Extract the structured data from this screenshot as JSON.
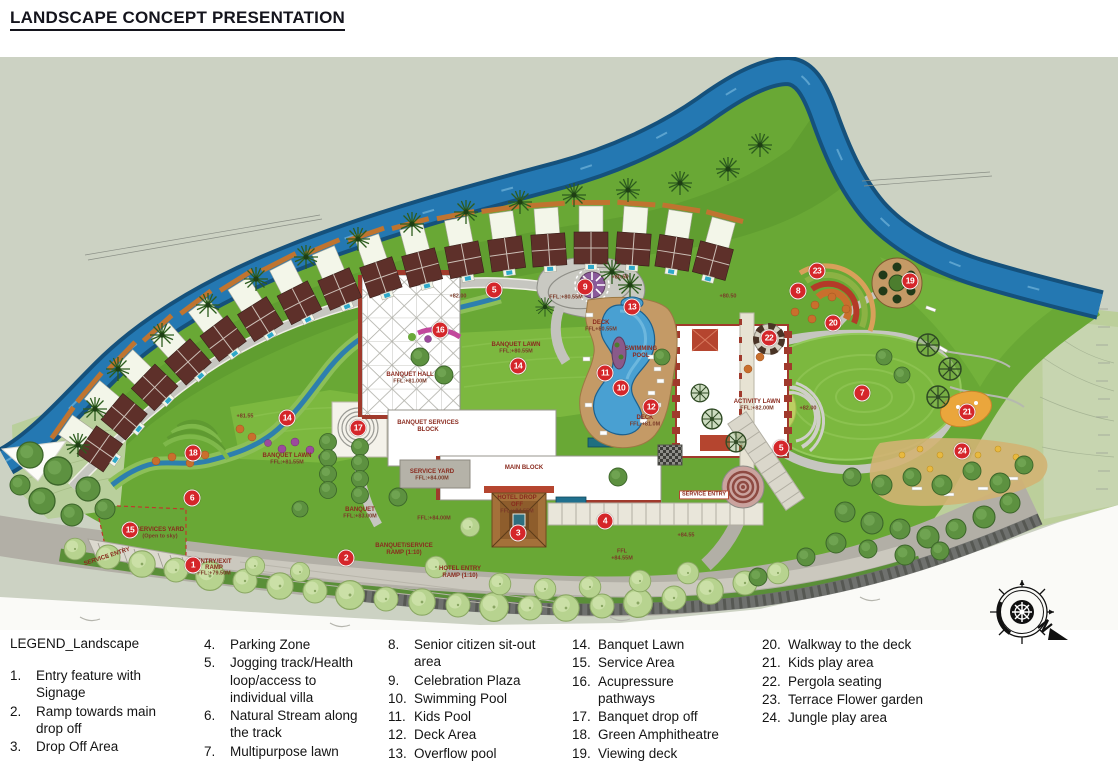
{
  "title": "LANDSCAPE CONCEPT PRESENTATION",
  "legend": {
    "title": "LEGEND_Landscape",
    "columns": [
      {
        "items": [
          {
            "n": "1.",
            "t": "Entry feature with Signage"
          },
          {
            "n": "2.",
            "t": "Ramp towards main drop off"
          },
          {
            "n": "3.",
            "t": "Drop Off Area"
          }
        ]
      },
      {
        "items": [
          {
            "n": "4.",
            "t": "Parking Zone"
          },
          {
            "n": "5.",
            "t": "Jogging track/Health loop/access to individual villa"
          },
          {
            "n": "6.",
            "t": "Natural Stream along the track"
          },
          {
            "n": "7.",
            "t": "Multipurpose lawn"
          }
        ]
      },
      {
        "items": [
          {
            "n": "8.",
            "t": "Senior citizen sit-out area"
          },
          {
            "n": "9.",
            "t": "Celebration Plaza"
          },
          {
            "n": "10.",
            "t": "Swimming Pool"
          },
          {
            "n": "11.",
            "t": "Kids Pool"
          },
          {
            "n": "12.",
            "t": "Deck Area"
          },
          {
            "n": "13.",
            "t": "Overflow pool"
          }
        ]
      },
      {
        "items": [
          {
            "n": "14.",
            "t": "Banquet Lawn"
          },
          {
            "n": "15.",
            "t": "Service Area"
          },
          {
            "n": "16.",
            "t": "Acupressure pathways"
          },
          {
            "n": "17.",
            "t": "Banquet drop off"
          },
          {
            "n": "18.",
            "t": "Green Amphitheatre"
          },
          {
            "n": "19.",
            "t": "Viewing deck"
          }
        ]
      },
      {
        "items": [
          {
            "n": "20.",
            "t": "Walkway to the deck"
          },
          {
            "n": "21.",
            "t": "Kids play area"
          },
          {
            "n": "22.",
            "t": "Pergola seating"
          },
          {
            "n": "23.",
            "t": "Terrace Flower garden"
          },
          {
            "n": "24.",
            "t": "Jungle play area"
          }
        ]
      }
    ]
  },
  "map": {
    "markers": [
      {
        "n": "1",
        "x": 193,
        "y": 508
      },
      {
        "n": "2",
        "x": 346,
        "y": 501
      },
      {
        "n": "3",
        "x": 518,
        "y": 476
      },
      {
        "n": "4",
        "x": 605,
        "y": 464
      },
      {
        "n": "5",
        "x": 494,
        "y": 233
      },
      {
        "n": "5",
        "x": 781,
        "y": 391
      },
      {
        "n": "6",
        "x": 192,
        "y": 441
      },
      {
        "n": "7",
        "x": 862,
        "y": 336
      },
      {
        "n": "8",
        "x": 798,
        "y": 234
      },
      {
        "n": "9",
        "x": 585,
        "y": 230
      },
      {
        "n": "10",
        "x": 621,
        "y": 331
      },
      {
        "n": "11",
        "x": 605,
        "y": 316
      },
      {
        "n": "12",
        "x": 651,
        "y": 350
      },
      {
        "n": "13",
        "x": 632,
        "y": 250
      },
      {
        "n": "14",
        "x": 518,
        "y": 309
      },
      {
        "n": "14",
        "x": 287,
        "y": 361
      },
      {
        "n": "15",
        "x": 130,
        "y": 473
      },
      {
        "n": "16",
        "x": 440,
        "y": 273
      },
      {
        "n": "17",
        "x": 358,
        "y": 371
      },
      {
        "n": "18",
        "x": 193,
        "y": 396
      },
      {
        "n": "19",
        "x": 910,
        "y": 224
      },
      {
        "n": "20",
        "x": 833,
        "y": 266
      },
      {
        "n": "21",
        "x": 967,
        "y": 355
      },
      {
        "n": "22",
        "x": 769,
        "y": 281
      },
      {
        "n": "23",
        "x": 817,
        "y": 214
      },
      {
        "n": "24",
        "x": 962,
        "y": 394
      }
    ],
    "labels": [
      {
        "t": "BANQUET HALL",
        "x": 410,
        "y": 318
      },
      {
        "t": "FFL:+81.00M",
        "x": 410,
        "y": 325,
        "c": "elev"
      },
      {
        "t": "BANQUET LAWN",
        "x": 516,
        "y": 288
      },
      {
        "t": "FFL:+80.55M",
        "x": 516,
        "y": 295,
        "c": "elev"
      },
      {
        "t": "BANQUET LAWN",
        "x": 287,
        "y": 399
      },
      {
        "t": "FFL:+81.55M",
        "x": 287,
        "y": 406,
        "c": "elev"
      },
      {
        "t": "BANQUET SERVICES",
        "x": 428,
        "y": 366
      },
      {
        "t": "BLOCK",
        "x": 428,
        "y": 373
      },
      {
        "t": "MAIN BLOCK",
        "x": 524,
        "y": 411
      },
      {
        "t": "SERVICE YARD",
        "x": 432,
        "y": 415
      },
      {
        "t": "FFL:+84.00M",
        "x": 432,
        "y": 422,
        "c": "elev"
      },
      {
        "t": "SERVICES YARD",
        "x": 160,
        "y": 473
      },
      {
        "t": "(Open to sky)",
        "x": 160,
        "y": 480,
        "c": "elev"
      },
      {
        "t": "SERVICE ENTRY",
        "x": 107,
        "y": 500,
        "r": -18
      },
      {
        "t": "SERVICE ENTRY",
        "x": 704,
        "y": 438,
        "c": "boxed",
        "s": 5.5
      },
      {
        "t": "HOTEL DROP",
        "x": 517,
        "y": 441
      },
      {
        "t": "OFF",
        "x": 517,
        "y": 448
      },
      {
        "t": "FFL:+84.55M",
        "x": 517,
        "y": 455,
        "c": "elev"
      },
      {
        "t": "SWIMMING",
        "x": 641,
        "y": 292
      },
      {
        "t": "POOL",
        "x": 641,
        "y": 299
      },
      {
        "t": "DECK",
        "x": 601,
        "y": 266
      },
      {
        "t": "FFL+80.55M",
        "x": 601,
        "y": 273,
        "c": "elev"
      },
      {
        "t": "DECK",
        "x": 645,
        "y": 361
      },
      {
        "t": "FFL:+81.0M",
        "x": 645,
        "y": 368,
        "c": "elev"
      },
      {
        "t": "BANQUET",
        "x": 360,
        "y": 453
      },
      {
        "t": "FFL:+83.00M",
        "x": 360,
        "y": 460,
        "c": "elev"
      },
      {
        "t": "BANQUET/SERVICE",
        "x": 404,
        "y": 489
      },
      {
        "t": "RAMP (1:10)",
        "x": 404,
        "y": 496
      },
      {
        "t": "HOTEL ENTRY",
        "x": 460,
        "y": 512
      },
      {
        "t": "RAMP (1:10)",
        "x": 460,
        "y": 519
      },
      {
        "t": "ENTRY/EXIT",
        "x": 214,
        "y": 505
      },
      {
        "t": "RAMP",
        "x": 214,
        "y": 511
      },
      {
        "t": "FFL:+79.50M",
        "x": 214,
        "y": 517,
        "c": "elev"
      },
      {
        "t": "ACTIVITY LAWN",
        "x": 757,
        "y": 345
      },
      {
        "t": "FFL:+82.00M",
        "x": 757,
        "y": 352,
        "c": "elev"
      },
      {
        "t": "+82.00",
        "x": 808,
        "y": 352,
        "c": "elev"
      },
      {
        "t": "+81.55",
        "x": 245,
        "y": 360,
        "c": "elev"
      },
      {
        "t": "+82.00",
        "x": 458,
        "y": 240,
        "c": "elev"
      },
      {
        "t": "+80.50",
        "x": 728,
        "y": 240,
        "c": "elev"
      },
      {
        "t": "+80.50",
        "x": 620,
        "y": 221,
        "c": "elev"
      },
      {
        "t": "+84.55",
        "x": 686,
        "y": 479,
        "c": "elev"
      },
      {
        "t": "FFL",
        "x": 622,
        "y": 495,
        "c": "elev"
      },
      {
        "t": "+84.55M",
        "x": 622,
        "y": 502,
        "c": "elev"
      },
      {
        "t": "FFL:+84.00M",
        "x": 434,
        "y": 462,
        "c": "elev"
      },
      {
        "t": "FFL:+80.55M",
        "x": 566,
        "y": 241,
        "c": "elev"
      }
    ],
    "colors": {
      "background_sage": "#ccd2c3",
      "site_green": "#69a835",
      "lawn_green": "#7cb83f",
      "river_blue": "#2478b2",
      "pool_blue": "#49a0d2",
      "deck_tan": "#c49a66",
      "roof_maroon": "#5e302a",
      "road_gray": "#b2afa6",
      "marker_red": "#d5262a",
      "plan_label_red": "#8a2a1e"
    },
    "compass": {
      "type": "compass-rose-with-north-arrow"
    }
  }
}
